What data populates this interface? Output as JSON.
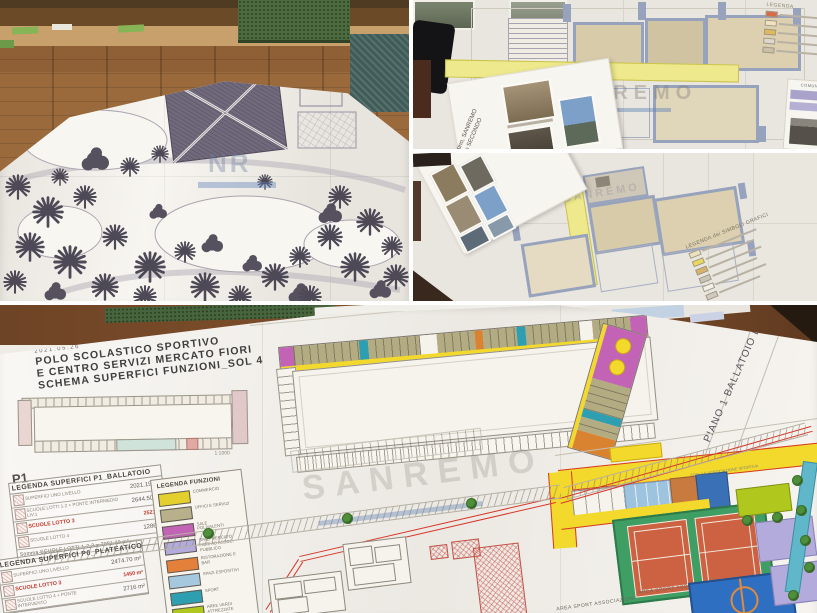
{
  "panel_site_plan": {
    "watermark": "NR"
  },
  "panel_plan_upper": {
    "booklet_line1": "Martino, SANREMO",
    "booklet_line2": "Piano SECONDO",
    "watermark": "SANREMO",
    "legend_title": "LEGENDA",
    "doc_header": "COMUNE"
  },
  "panel_plan_lower": {
    "booklet_line1": "GES, San Martino, SANREMO",
    "booklet_line2": "Pianta Piano SECONDO",
    "legend_title": "LEGENDA dei SIMBOLI GRAFICI",
    "watermark": "SANREMO"
  },
  "panel_masterplan": {
    "date": "2021.05.26",
    "title_line1": "POLO SCOLASTICO SPORTIVO",
    "title_line2": "E CENTRO SERVIZI  MERCATO FIORI",
    "title_line3": "SCHEMA SUPERFICI FUNZIONI_SOL 4",
    "floor_label": "P1",
    "scale_label": "1:1000",
    "piano_label": "PIANO 1 BALLATOIO LOTTO III",
    "watermark": "SANREMO",
    "area_sport_label_1": "AREA SPORT ASSOCIAZIONI",
    "area_sport_label_2": "AREA SPORT ASSOCIAZIONI",
    "sports_note": "SCALA E ASSOCIAZIONE SPORTIVA",
    "table_p1": {
      "title": "LEGENDA SUPERFICI P1_BALLATOIO",
      "rows": [
        {
          "label": "SUPERFICI UNO LIVELLO",
          "value": "2021.19 m²"
        },
        {
          "label": "SCUOLE LOTTI 1-2 + PONTE INTERMEDIO LIV.1",
          "value": "2644.50 m²"
        },
        {
          "label": "SCUOLE LOTTO 3",
          "value": "2521 m²"
        },
        {
          "label": "SCUOLE LOTTO 4",
          "value": "1286 m²"
        }
      ],
      "footer": "Somma SCUOLE LOTTI 1-2-3 = 7091.20 m²"
    },
    "table_p0": {
      "title": "LEGENDA SUPERFICI P0_PLATEATICO",
      "rows": [
        {
          "label": "SUPERFICI UNO LIVELLO",
          "value": "2474.70 m²"
        },
        {
          "label": "SCUOLE LOTTO 3",
          "value": "1450 m²"
        },
        {
          "label": "SCUOLE LOTTO 4 + PONTE INTERVENTO",
          "value": "2716 m²"
        }
      ]
    },
    "legend_funzioni": {
      "title": "LEGENDA FUNZIONI",
      "items": [
        {
          "label": "COMMERCIO",
          "color": "#e3cf2e"
        },
        {
          "label": "UFFICI E SERVIZI",
          "color": "#b7b08a"
        },
        {
          "label": "SALE POLIVALENTI",
          "color": "#c263b5"
        },
        {
          "label": "SPAZI MERCATO FIORI AD ASSOC. PUBBLICO",
          "color": "#b3abdb"
        },
        {
          "label": "RISTORAZIONE E BAR",
          "color": "#e5803a"
        },
        {
          "label": "SPAZI ESPOSITIVI",
          "color": "#a6c8df"
        },
        {
          "label": "SPORT",
          "color": "#2d9fb0"
        },
        {
          "label": "AREE VERDI ATTREZZATE PUBBLICO",
          "color": "#b0c81d"
        }
      ]
    }
  }
}
